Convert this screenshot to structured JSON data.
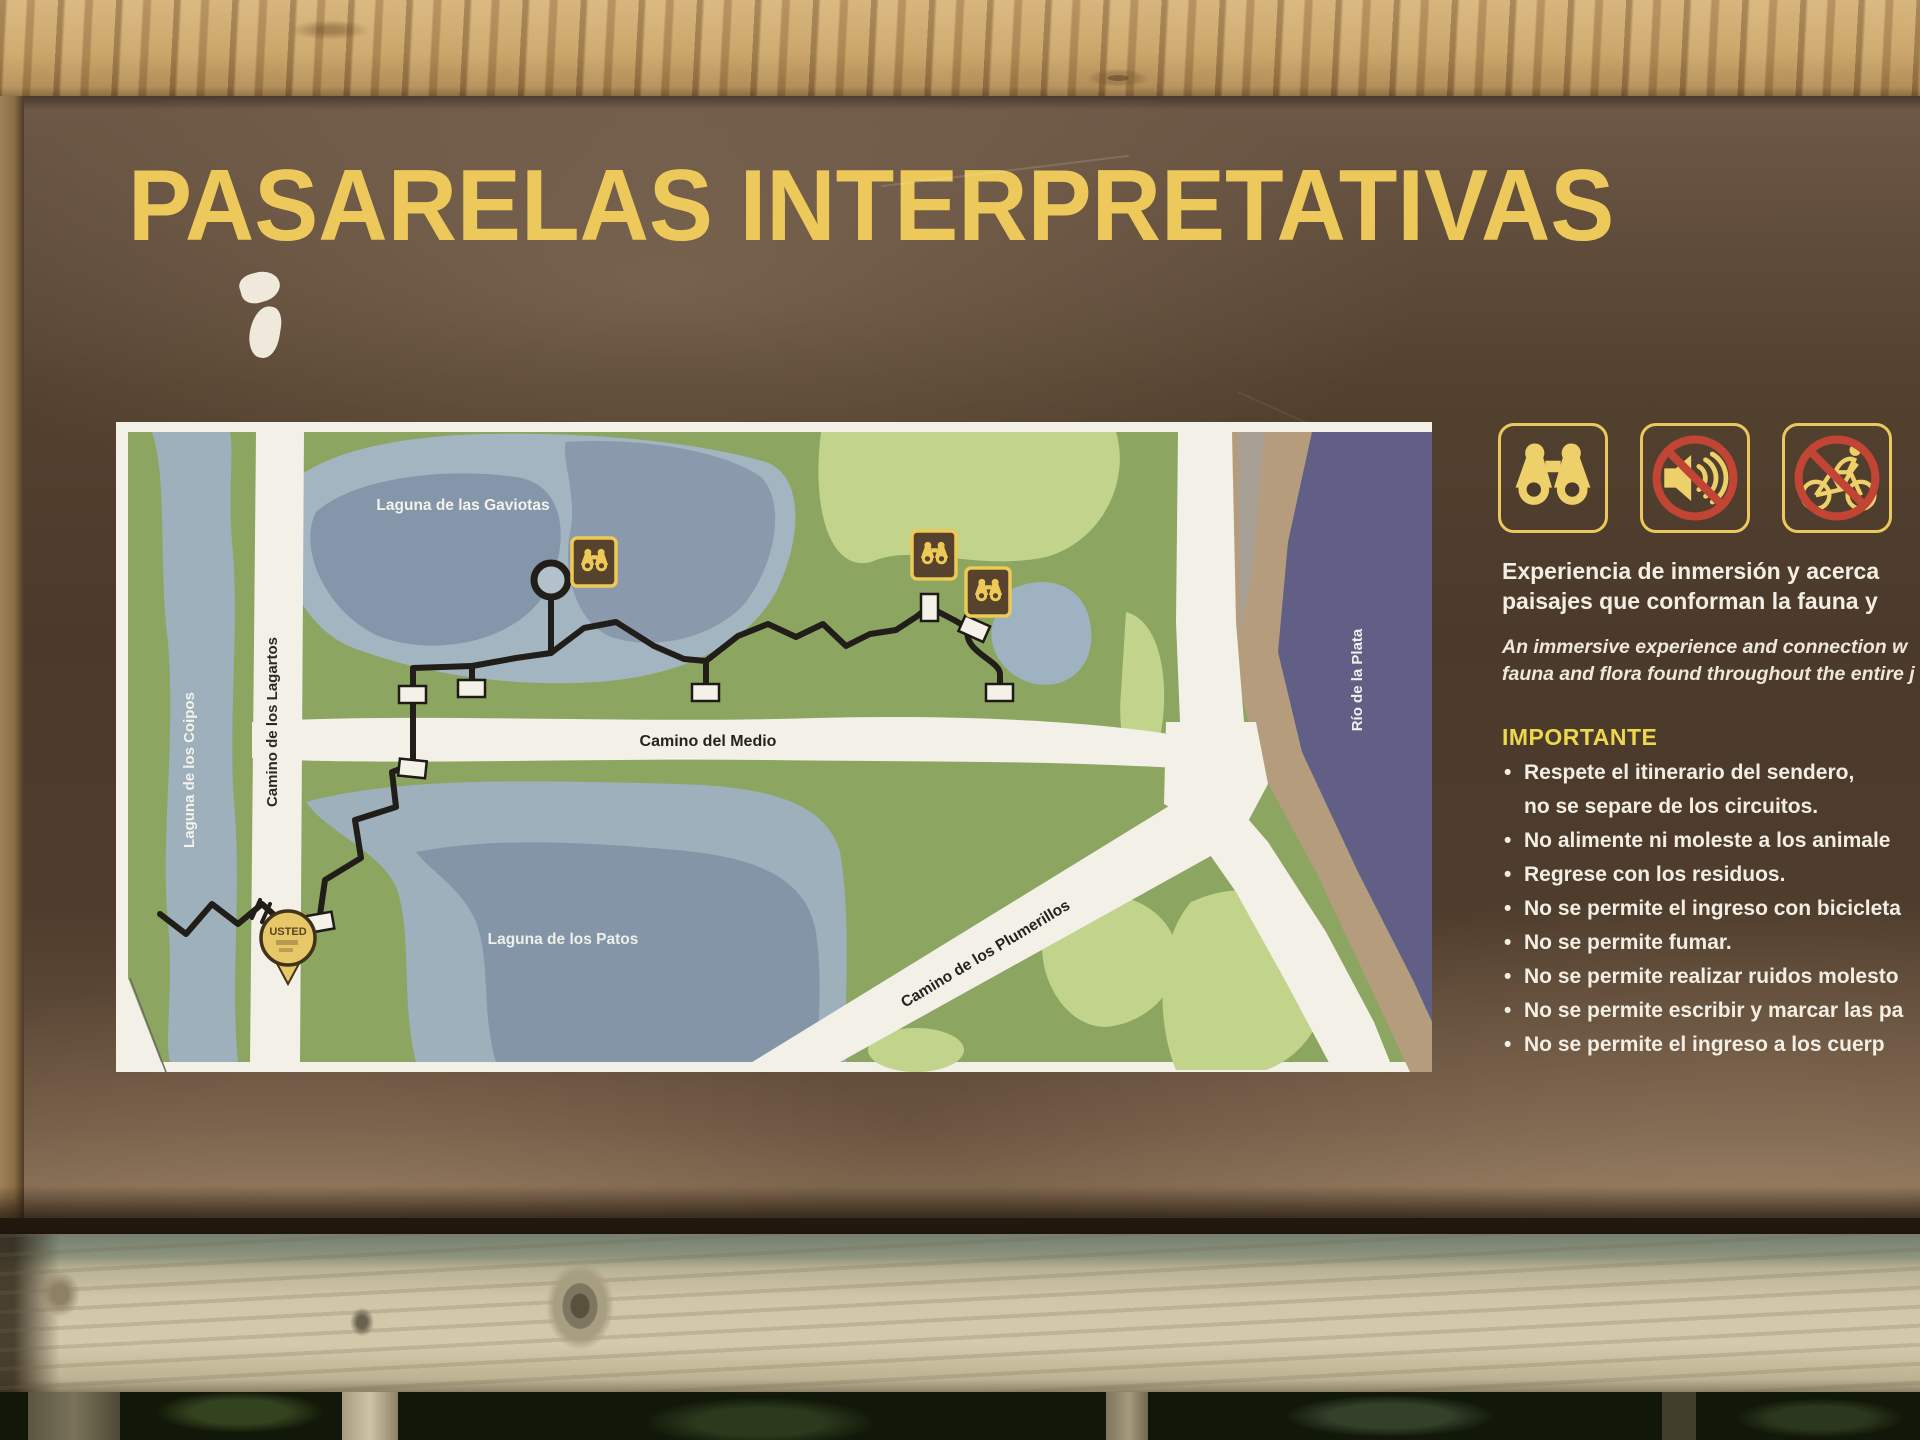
{
  "sign": {
    "title": "PASARELAS INTERPRETATIVAS",
    "intro_es": "Experiencia de inmersión y acerca\npaisajes que conforman la fauna y",
    "intro_en": "An immersive experience and connection w\nfauna and flora found throughout the entire j",
    "important_heading": "IMPORTANTE",
    "rules": [
      "Respete el itinerario del sendero,\nno se separe de los circuitos.",
      "No alimente ni moleste a los animale",
      "Regrese con los residuos.",
      "No se permite el ingreso con bicicleta",
      "No se permite fumar.",
      "No se permite realizar ruidos molesto",
      "No se permite escribir y marcar las pa",
      "No se permite el ingreso a los cuerp"
    ],
    "pictograms": [
      "binoculars",
      "no-noise",
      "no-bicycles"
    ]
  },
  "map": {
    "labels": {
      "gaviotas": "Laguna de las Gaviotas",
      "coipos": "Laguna de los Coipos",
      "lagartos": "Camino de los Lagartos",
      "medio": "Camino del Medio",
      "patos": "Laguna de los Patos",
      "plumerillos": "Camino de los Plumerillos",
      "rio": "Río de la Plata"
    },
    "you_are_here": "USTED",
    "viewpoint_count": 3
  },
  "colors": {
    "board_brown": "#4b3a2b",
    "accent_yellow": "#e9c95e",
    "map_green": "#8ca561",
    "map_light_green": "#c2d38b",
    "lagoon_blue": "#9db0bc",
    "river_purple": "#615f86",
    "sand_tan": "#b59c7d",
    "path_white": "#f3f0e8",
    "prohibition_red": "#c14434",
    "text_white": "#f3eee3"
  }
}
